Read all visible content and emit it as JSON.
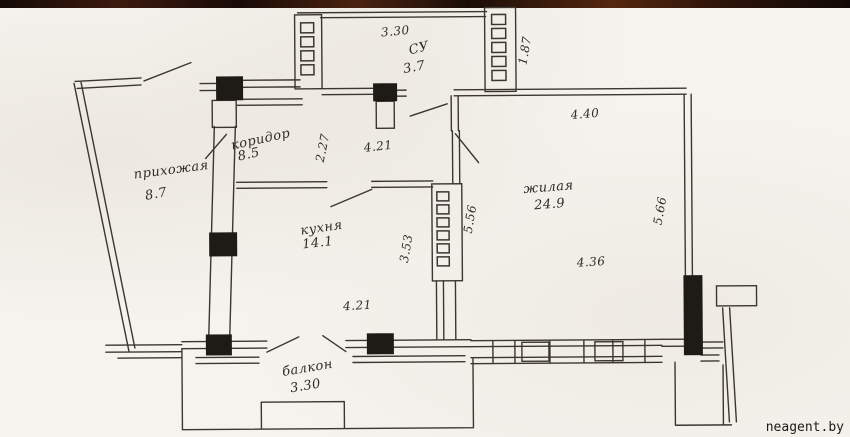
{
  "colors": {
    "paper": "#f5f3ee",
    "ink": "#3b3630",
    "pillar_fill": "#1e1b17",
    "photo_edge_dark": "#140a06",
    "photo_edge_brown": "#54260f"
  },
  "watermark": "neagent.by",
  "rooms": [
    {
      "name": "прихожая",
      "area": "8.7"
    },
    {
      "name": "коридор",
      "area": "8.5"
    },
    {
      "name": "СУ",
      "area": "3.7"
    },
    {
      "name": "кухня",
      "area": "14.1"
    },
    {
      "name": "жилая",
      "area": "24.9"
    },
    {
      "name": "балкон",
      "area": "3.30"
    }
  ],
  "dimensions": {
    "bathroom_width": "3.30",
    "bathroom_depth": "1.87",
    "corridor_depth": "2.27",
    "corridor_width": "4.21",
    "living_width_top": "4.40",
    "living_depth_left": "5.56",
    "living_depth_right": "5.66",
    "living_width_bottom": "4.36",
    "kitchen_depth": "3.53",
    "kitchen_width": "4.21"
  }
}
